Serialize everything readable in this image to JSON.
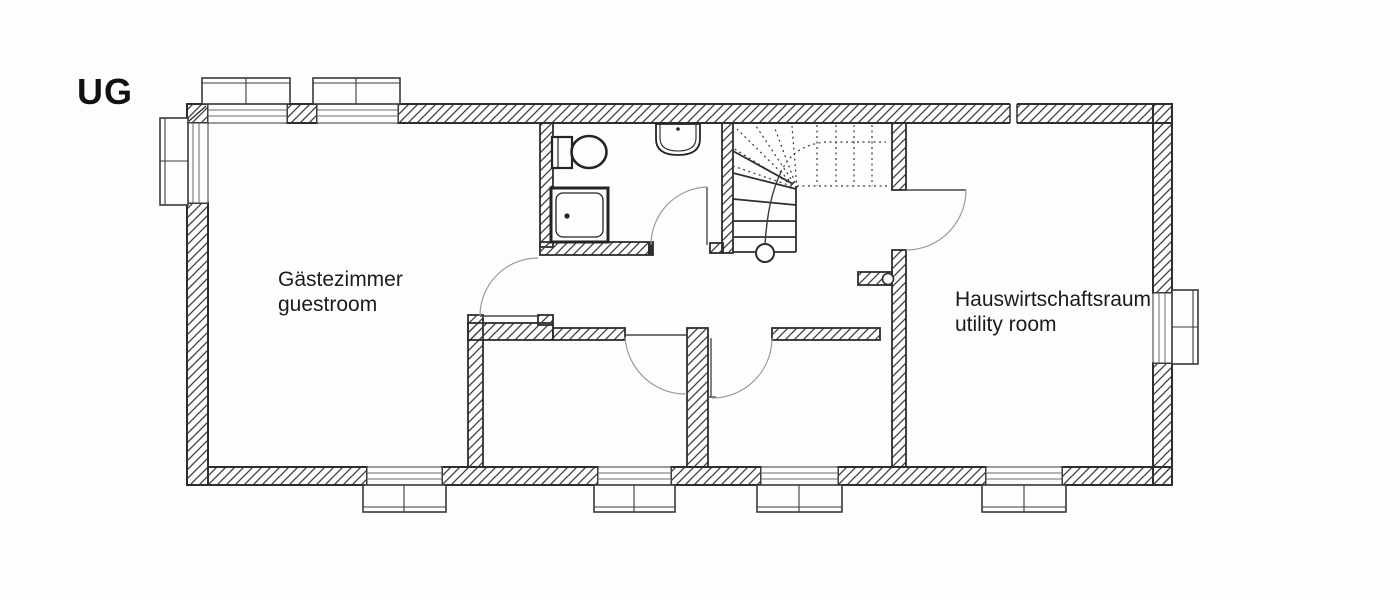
{
  "floor_label": "UG",
  "rooms": {
    "guestroom": {
      "de": "Gästezimmer",
      "en": "guestroom"
    },
    "utility": {
      "de": "Hauswirtschaftsraum",
      "en": "utility room"
    }
  },
  "fixtures": [
    "toilet-icon",
    "sink-icon",
    "shower-tray-icon",
    "staircase",
    "walking-line-start-circle"
  ],
  "features": {
    "doors": [
      "guestroom-door",
      "bathroom-door",
      "utility-room-door",
      "storage-room-1-door",
      "storage-room-2-door"
    ],
    "windows_top": 2,
    "windows_bottom": 4,
    "windows_left": 1,
    "windows_right": 1
  },
  "colors": {
    "background": "#fdfdfd",
    "wall_line": "#2e2e2e",
    "thin_line": "#6a6a6a",
    "door_arc": "#9a9a9a",
    "text": "#1c1c1c"
  }
}
